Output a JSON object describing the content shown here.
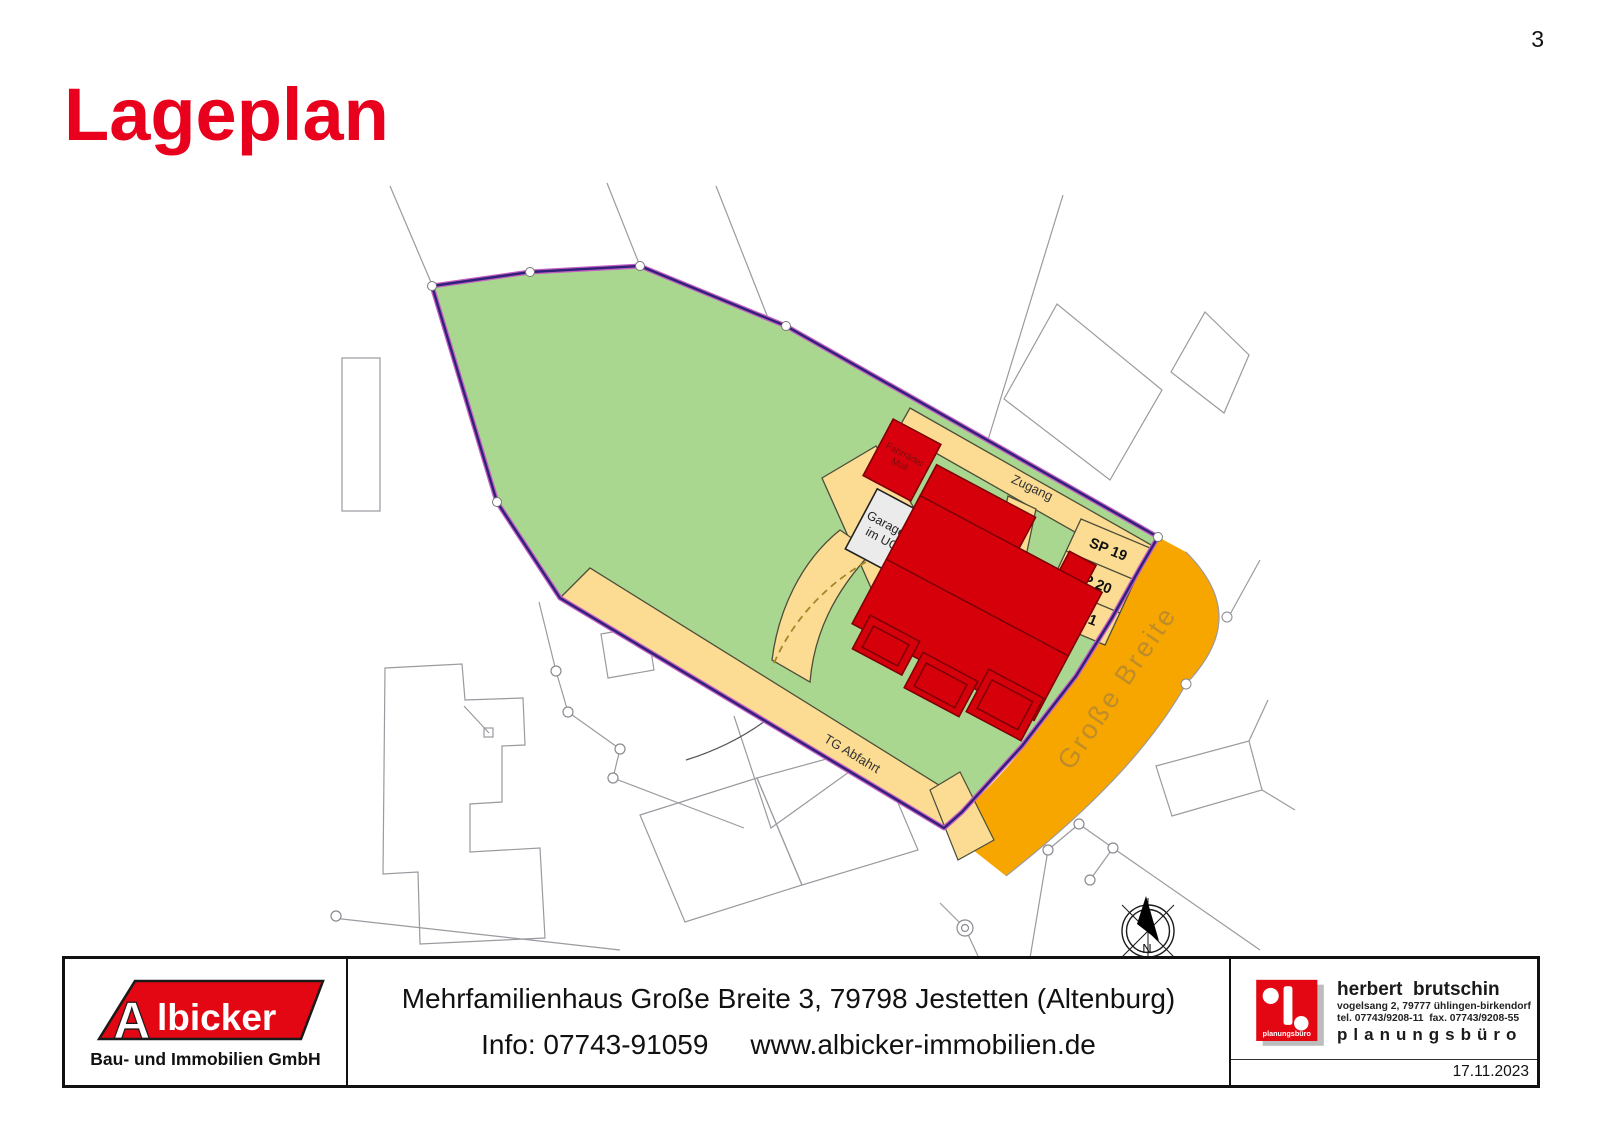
{
  "page": {
    "number": "3"
  },
  "title": "Lageplan",
  "plan": {
    "labels": {
      "fahrraeder": "Fahrräder",
      "muell": "Müll",
      "garagen1": "Garagen",
      "garagen2": "im UG",
      "zugang": "Zugang",
      "tg_abfahrt": "TG Abfahrt",
      "street": "Große Breite",
      "north": "N"
    },
    "stalls": [
      "SP 19",
      "SP 20",
      "SP 21"
    ]
  },
  "colors": {
    "accent_red": "#E30613",
    "title_red": "#E8001C",
    "parcel_green": "#A9D78F",
    "boundary_purple": "#2F2178",
    "boundary_magenta": "#C45EC4",
    "road_orange": "#F7A600",
    "path_yellow": "#FBDC92",
    "building_red": "#D6000B",
    "building_outline": "#7F0006",
    "garage_gray": "#EBEBEB",
    "cadastral_gray": "#9A9AA0",
    "street_label": "#BB8A2E"
  },
  "footer": {
    "left": {
      "logo_a": "A",
      "logo_rest": "lbicker",
      "subtitle": "Bau- und Immobilien GmbH"
    },
    "center": {
      "line1": "Mehrfamilienhaus Große Breite 3, 79798 Jestetten (Altenburg)",
      "info": "Info: 07743-91059",
      "web": "www.albicker-immobilien.de"
    },
    "right": {
      "name": "herbert  brutschin",
      "address": "vogelsang 2, 79777 ühlingen-birkendorf",
      "phone": "tel. 07743/9208-11  fax. 07743/9208-55",
      "tagline": "planungsbüro",
      "logo_caption": "planungsbüro",
      "date": "17.11.2023"
    }
  }
}
